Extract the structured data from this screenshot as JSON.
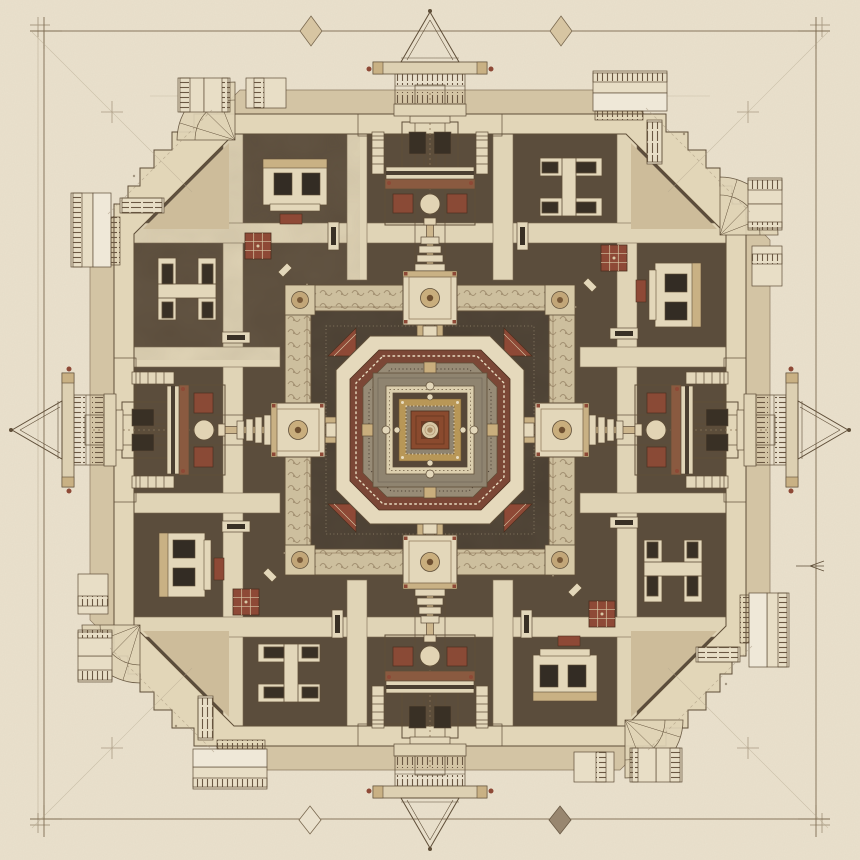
{
  "artwork": {
    "type": "architectural-plan-drawing",
    "subject": "symmetric temple mandala floor plan, aerial view",
    "medium_look": "ink and sepia wash on parchment",
    "symmetry": "4-fold: cardinal gate pavilions, diagonal corner pavilions, concentric square and octagon rings",
    "canvas": {
      "width": 860,
      "height": 860
    }
  },
  "palette": {
    "paper": "#eae1cd",
    "ink": "#5f4e38",
    "ink_faint": "#a3937a",
    "base_wash": "#d3c4a4",
    "plaza": "#cdbc9a",
    "court_dark": "#5b4d3c",
    "court_shadow": "#42382c",
    "wall_cream": "#e2d6b8",
    "corridor": "#e0d4b6",
    "cream_light": "#e8dec6",
    "causeway": "#c9b184",
    "ornate_band": "#cdbf9e",
    "inner_field": "#4a3f32",
    "cream_octagon": "#e5d9bc",
    "maroon_ring": "#7b4736",
    "grey_field": "#8f8470",
    "gold_ring": "#b89757",
    "rust_center": "#8a4a2e",
    "boss_cream": "#d8c8a6",
    "red_accent": "#8e4936",
    "dark_void": "#393025",
    "diamond_tan": "#d7c5a2",
    "diamond_dark": "#98866f"
  },
  "border": {
    "left": 44,
    "top": 31,
    "right": 816,
    "bottom": 819,
    "diamonds": [
      {
        "x": 311,
        "y": 31,
        "style": "tan"
      },
      {
        "x": 561,
        "y": 31,
        "style": "tan"
      },
      {
        "x": 310,
        "y": 820,
        "style": "outline"
      },
      {
        "x": 560,
        "y": 820,
        "style": "dark"
      }
    ],
    "registration_crosses": 4,
    "right_edge_arrow": {
      "x": 812,
      "y": 566
    }
  },
  "plan": {
    "center_x": 430,
    "center_y": 430,
    "outer_wall_half": 316,
    "ornate_frame_half": 145,
    "inner_field_half": 119,
    "cream_octagon_half": 94,
    "maroon_octagon_half": 80,
    "grey_platform_half": 57,
    "gold_ring_half": 31,
    "central_altar_half": 19,
    "boss_radius": 8.5,
    "corridor_offsets": [
      73,
      197
    ],
    "corridor_width": 20,
    "cardinal_gates": 4,
    "corner_pavilions": 4,
    "side_galleries": 8
  },
  "parts": [
    "drafting-border",
    "border-diamond",
    "registration-cross",
    "outer-wall",
    "corner-plaza",
    "corner-fan-pavilion",
    "side-gallery",
    "cardinal-gate",
    "gate-pediment",
    "gate-railing-gallery",
    "gate-window-block",
    "axial-causeway",
    "spine-totem",
    "winged-pavilion",
    "courtyard",
    "corridor-grid",
    "court-building-h",
    "court-window-house",
    "red-carpet",
    "court-chairs",
    "ornate-frame",
    "frame-gate-medallion",
    "frame-corner-rosette",
    "inner-sanctum-field",
    "corner-red-motif",
    "cream-octagon-ring",
    "maroon-octagon-ring",
    "rosary-dot-ring",
    "grey-inner-platform",
    "cream-square-ring",
    "gold-square-ring",
    "central-altar",
    "central-boss"
  ]
}
